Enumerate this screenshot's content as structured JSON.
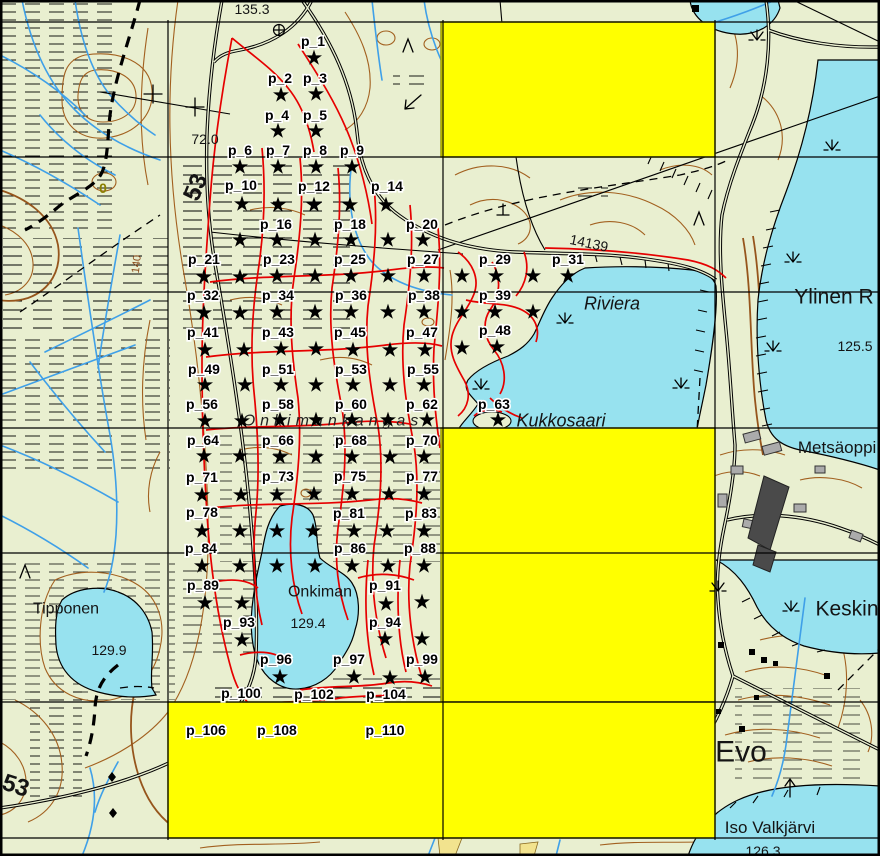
{
  "map_canvas": {
    "width": 880,
    "height": 856,
    "colors": {
      "land": "#E9EFD0",
      "water": "#97E2EF",
      "contour": "#A2601F",
      "trail_red": "#E60000",
      "stream_blue": "#3FA0E8",
      "highlight_yellow": "#FFFF00",
      "highlight_border": "#9A9A00",
      "grid_black": "#000000",
      "marker_black": "#000000"
    },
    "grid": {
      "v": [
        168,
        443,
        715
      ],
      "h": [
        22,
        157,
        292,
        428,
        553,
        702,
        838
      ]
    },
    "highlight_cells": [
      {
        "x": 441,
        "y": 22,
        "w": 274,
        "h": 135
      },
      {
        "x": 441,
        "y": 428,
        "w": 274,
        "h": 274
      },
      {
        "x": 168,
        "y": 702,
        "w": 547,
        "h": 136
      }
    ],
    "points": [
      {
        "label": "p_1",
        "x": 313,
        "y": 41
      },
      {
        "label": "p_2",
        "x": 280,
        "y": 78
      },
      {
        "label": "p_3",
        "x": 315,
        "y": 78
      },
      {
        "label": "p_4",
        "x": 277,
        "y": 115
      },
      {
        "label": "p_5",
        "x": 315,
        "y": 115
      },
      {
        "label": "p_6",
        "x": 240,
        "y": 150
      },
      {
        "label": "p_7",
        "x": 278,
        "y": 150
      },
      {
        "label": "p_8",
        "x": 315,
        "y": 150
      },
      {
        "label": "p_9",
        "x": 352,
        "y": 150
      },
      {
        "label": "p_10",
        "x": 241,
        "y": 185
      },
      {
        "label": "p_12",
        "x": 314,
        "y": 186
      },
      {
        "label": "p_14",
        "x": 387,
        "y": 186
      },
      {
        "label": "p_16",
        "x": 276,
        "y": 224
      },
      {
        "label": "p_18",
        "x": 350,
        "y": 224
      },
      {
        "label": "p_20",
        "x": 422,
        "y": 224
      },
      {
        "label": "p_21",
        "x": 204,
        "y": 259
      },
      {
        "label": "p_23",
        "x": 279,
        "y": 259
      },
      {
        "label": "p_25",
        "x": 350,
        "y": 259
      },
      {
        "label": "p_27",
        "x": 423,
        "y": 259
      },
      {
        "label": "p_29",
        "x": 495,
        "y": 259
      },
      {
        "label": "p_31",
        "x": 568,
        "y": 259
      },
      {
        "label": "p_32",
        "x": 203,
        "y": 295
      },
      {
        "label": "p_34",
        "x": 278,
        "y": 295
      },
      {
        "label": "p_36",
        "x": 351,
        "y": 295
      },
      {
        "label": "p_38",
        "x": 424,
        "y": 295
      },
      {
        "label": "p_39",
        "x": 495,
        "y": 295
      },
      {
        "label": "p_41",
        "x": 203,
        "y": 332
      },
      {
        "label": "p_43",
        "x": 278,
        "y": 332
      },
      {
        "label": "p_45",
        "x": 350,
        "y": 332
      },
      {
        "label": "p_47",
        "x": 422,
        "y": 332
      },
      {
        "label": "p_48",
        "x": 495,
        "y": 330
      },
      {
        "label": "p_49",
        "x": 204,
        "y": 369
      },
      {
        "label": "p_51",
        "x": 278,
        "y": 369
      },
      {
        "label": "p_53",
        "x": 351,
        "y": 369
      },
      {
        "label": "p_55",
        "x": 423,
        "y": 369
      },
      {
        "label": "p_56",
        "x": 202,
        "y": 404
      },
      {
        "label": "p_58",
        "x": 278,
        "y": 404
      },
      {
        "label": "p_60",
        "x": 351,
        "y": 404
      },
      {
        "label": "p_62",
        "x": 422,
        "y": 404
      },
      {
        "label": "p_63",
        "x": 494,
        "y": 404
      },
      {
        "label": "p_64",
        "x": 203,
        "y": 440
      },
      {
        "label": "p_66",
        "x": 278,
        "y": 440
      },
      {
        "label": "p_68",
        "x": 351,
        "y": 440
      },
      {
        "label": "p_70",
        "x": 422,
        "y": 440
      },
      {
        "label": "p_71",
        "x": 202,
        "y": 477
      },
      {
        "label": "p_73",
        "x": 278,
        "y": 476
      },
      {
        "label": "p_75",
        "x": 350,
        "y": 476
      },
      {
        "label": "p_77",
        "x": 422,
        "y": 476
      },
      {
        "label": "p_78",
        "x": 202,
        "y": 512
      },
      {
        "label": "p_81",
        "x": 349,
        "y": 513
      },
      {
        "label": "p_83",
        "x": 421,
        "y": 513
      },
      {
        "label": "p_84",
        "x": 201,
        "y": 548
      },
      {
        "label": "p_86",
        "x": 350,
        "y": 548
      },
      {
        "label": "p_88",
        "x": 420,
        "y": 548
      },
      {
        "label": "p_89",
        "x": 203,
        "y": 585
      },
      {
        "label": "p_91",
        "x": 385,
        "y": 585
      },
      {
        "label": "p_93",
        "x": 239,
        "y": 622
      },
      {
        "label": "p_94",
        "x": 385,
        "y": 622
      },
      {
        "label": "p_96",
        "x": 276,
        "y": 659
      },
      {
        "label": "p_97",
        "x": 349,
        "y": 659
      },
      {
        "label": "p_99",
        "x": 422,
        "y": 659
      },
      {
        "label": "p_100",
        "x": 241,
        "y": 693
      },
      {
        "label": "p_102",
        "x": 314,
        "y": 694
      },
      {
        "label": "p_104",
        "x": 386,
        "y": 694
      },
      {
        "label": "p_106",
        "x": 206,
        "y": 730
      },
      {
        "label": "p_108",
        "x": 277,
        "y": 730
      },
      {
        "label": "p_110",
        "x": 385,
        "y": 730
      }
    ],
    "stars": [
      [
        314,
        58
      ],
      [
        281,
        95
      ],
      [
        316,
        94
      ],
      [
        278,
        131
      ],
      [
        316,
        131
      ],
      [
        240,
        167
      ],
      [
        278,
        167
      ],
      [
        316,
        167
      ],
      [
        352,
        167
      ],
      [
        242,
        204
      ],
      [
        278,
        205
      ],
      [
        314,
        205
      ],
      [
        350,
        205
      ],
      [
        386,
        205
      ],
      [
        240,
        240
      ],
      [
        277,
        240
      ],
      [
        315,
        240
      ],
      [
        351,
        240
      ],
      [
        388,
        240
      ],
      [
        423,
        240
      ],
      [
        204,
        277
      ],
      [
        240,
        277
      ],
      [
        277,
        276
      ],
      [
        315,
        276
      ],
      [
        351,
        276
      ],
      [
        388,
        276
      ],
      [
        424,
        276
      ],
      [
        462,
        276
      ],
      [
        496,
        276
      ],
      [
        533,
        276
      ],
      [
        568,
        276
      ],
      [
        204,
        313
      ],
      [
        240,
        313
      ],
      [
        277,
        312
      ],
      [
        315,
        312
      ],
      [
        351,
        312
      ],
      [
        388,
        312
      ],
      [
        424,
        312
      ],
      [
        462,
        312
      ],
      [
        495,
        312
      ],
      [
        533,
        312
      ],
      [
        205,
        350
      ],
      [
        244,
        350
      ],
      [
        281,
        349
      ],
      [
        316,
        349
      ],
      [
        353,
        350
      ],
      [
        390,
        350
      ],
      [
        425,
        350
      ],
      [
        462,
        348
      ],
      [
        497,
        347
      ],
      [
        205,
        385
      ],
      [
        245,
        385
      ],
      [
        281,
        385
      ],
      [
        316,
        385
      ],
      [
        353,
        385
      ],
      [
        390,
        385
      ],
      [
        424,
        385
      ],
      [
        205,
        421
      ],
      [
        242,
        421
      ],
      [
        280,
        420
      ],
      [
        316,
        420
      ],
      [
        352,
        420
      ],
      [
        388,
        420
      ],
      [
        427,
        420
      ],
      [
        498,
        420
      ],
      [
        204,
        456
      ],
      [
        240,
        456
      ],
      [
        280,
        457
      ],
      [
        316,
        457
      ],
      [
        352,
        457
      ],
      [
        390,
        457
      ],
      [
        424,
        457
      ],
      [
        202,
        495
      ],
      [
        241,
        495
      ],
      [
        277,
        495
      ],
      [
        314,
        494
      ],
      [
        352,
        494
      ],
      [
        389,
        494
      ],
      [
        424,
        494
      ],
      [
        202,
        531
      ],
      [
        240,
        531
      ],
      [
        277,
        531
      ],
      [
        313,
        531
      ],
      [
        354,
        531
      ],
      [
        387,
        531
      ],
      [
        424,
        531
      ],
      [
        202,
        566
      ],
      [
        240,
        566
      ],
      [
        277,
        566
      ],
      [
        315,
        566
      ],
      [
        352,
        566
      ],
      [
        388,
        566
      ],
      [
        424,
        566
      ],
      [
        205,
        603
      ],
      [
        242,
        603
      ],
      [
        386,
        604
      ],
      [
        422,
        602
      ],
      [
        242,
        640
      ],
      [
        385,
        639
      ],
      [
        422,
        639
      ],
      [
        280,
        677
      ],
      [
        354,
        677
      ],
      [
        390,
        678
      ],
      [
        425,
        677
      ]
    ],
    "place_labels": [
      {
        "text": "135.3",
        "x": 252,
        "y": 9,
        "cls": "elev",
        "rot": 0
      },
      {
        "text": "72.0",
        "x": 205,
        "y": 139,
        "cls": "elev",
        "rot": 0
      },
      {
        "text": "53",
        "x": 195,
        "y": 187,
        "cls": "road",
        "rot": -68
      },
      {
        "text": "53",
        "x": 16,
        "y": 785,
        "cls": "road",
        "rot": 18
      },
      {
        "text": "140",
        "x": 136,
        "y": 264,
        "cls": "small-brown",
        "rot": -83
      },
      {
        "text": "14139",
        "x": 589,
        "y": 243,
        "cls": "elev",
        "rot": 12
      },
      {
        "text": "Riviera",
        "x": 612,
        "y": 303,
        "cls": "name-it",
        "rot": 0
      },
      {
        "text": "Ylinen R",
        "x": 834,
        "y": 296,
        "cls": "name-lg",
        "rot": 0
      },
      {
        "text": "125.5",
        "x": 855,
        "y": 346,
        "cls": "elev",
        "rot": 0
      },
      {
        "text": "Kukkosaari",
        "x": 561,
        "y": 420,
        "cls": "name-it",
        "rot": 0
      },
      {
        "text": "Onkimankangas",
        "x": 333,
        "y": 420,
        "cls": "terrain",
        "rot": 0
      },
      {
        "text": "Metsäoppil",
        "x": 839,
        "y": 447,
        "cls": "name-md",
        "rot": 0
      },
      {
        "text": "Onkiman",
        "x": 320,
        "y": 591,
        "cls": "name",
        "rot": 0
      },
      {
        "text": "129.4",
        "x": 308,
        "y": 623,
        "cls": "elev",
        "rot": 0
      },
      {
        "text": "Tipponen",
        "x": 66,
        "y": 608,
        "cls": "name",
        "rot": 0
      },
      {
        "text": "129.9",
        "x": 109,
        "y": 650,
        "cls": "elev",
        "rot": 0
      },
      {
        "text": "Keskin",
        "x": 847,
        "y": 608,
        "cls": "name-lg",
        "rot": 0
      },
      {
        "text": "Evo",
        "x": 741,
        "y": 751,
        "cls": "name-xl",
        "rot": 0
      },
      {
        "text": "Iso Valkjärvi",
        "x": 770,
        "y": 827,
        "cls": "name-md",
        "rot": 0
      },
      {
        "text": "126.3",
        "x": 763,
        "y": 851,
        "cls": "elev",
        "rot": 0
      },
      {
        "text": "0",
        "x": 103,
        "y": 188,
        "cls": "olive",
        "rot": 0
      }
    ],
    "symbols": [
      {
        "type": "circle-plus-icon",
        "x": 279,
        "y": 30
      },
      {
        "type": "pylon-cross-icon",
        "x": 153,
        "y": 94
      },
      {
        "type": "pylon-cross-icon",
        "x": 195,
        "y": 107
      },
      {
        "type": "conifer-icon",
        "x": 408,
        "y": 46
      },
      {
        "type": "conifer-icon",
        "x": 699,
        "y": 219
      },
      {
        "type": "conifer-icon",
        "x": 25,
        "y": 572
      },
      {
        "type": "perp-icon",
        "x": 503,
        "y": 211
      },
      {
        "type": "arrow-sw-icon",
        "x": 412,
        "y": 102
      },
      {
        "type": "arrow-up-icon",
        "x": 790,
        "y": 788
      },
      {
        "type": "diamond-icon",
        "x": 112,
        "y": 777
      },
      {
        "type": "diamond-icon",
        "x": 113,
        "y": 813
      },
      {
        "type": "marsh-tuft-icon",
        "x": 565,
        "y": 323
      },
      {
        "type": "marsh-tuft-icon",
        "x": 481,
        "y": 389
      },
      {
        "type": "marsh-tuft-icon",
        "x": 681,
        "y": 388
      },
      {
        "type": "marsh-tuft-icon",
        "x": 793,
        "y": 262
      },
      {
        "type": "marsh-tuft-icon",
        "x": 773,
        "y": 351
      },
      {
        "type": "marsh-tuft-icon",
        "x": 718,
        "y": 591
      },
      {
        "type": "marsh-tuft-icon",
        "x": 791,
        "y": 611
      },
      {
        "type": "marsh-tuft-icon",
        "x": 832,
        "y": 150
      },
      {
        "type": "marsh-tuft-icon",
        "x": 757,
        "y": 40
      }
    ]
  }
}
